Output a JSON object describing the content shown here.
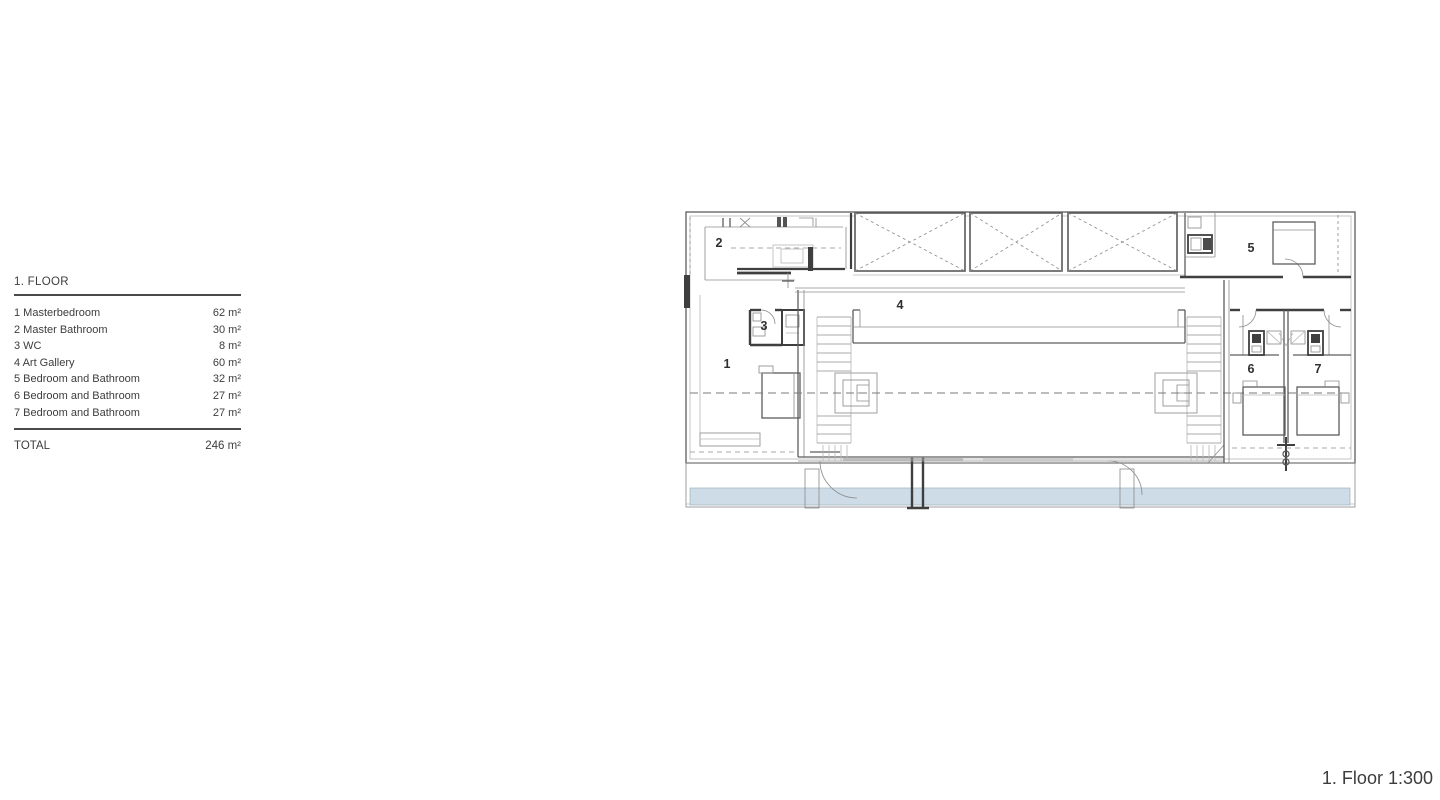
{
  "legend": {
    "title": "1. FLOOR",
    "rows": [
      {
        "name": "1 Masterbedroom",
        "area": "62 m²"
      },
      {
        "name": "2 Master Bathroom",
        "area": "30 m²"
      },
      {
        "name": "3 WC",
        "area": "8 m²"
      },
      {
        "name": "4 Art Gallery",
        "area": "60 m²"
      },
      {
        "name": "5 Bedroom and Bathroom",
        "area": "32 m²"
      },
      {
        "name": "6 Bedroom and Bathroom",
        "area": "27 m²"
      },
      {
        "name": "7 Bedroom and Bathroom",
        "area": "27 m²"
      }
    ],
    "total_label": "TOTAL",
    "total_area": "246 m²"
  },
  "plan": {
    "room_labels": [
      "1",
      "2",
      "3",
      "4",
      "5",
      "6",
      "7"
    ],
    "water_color": "#cddce7"
  },
  "caption": "1. Floor 1:300"
}
